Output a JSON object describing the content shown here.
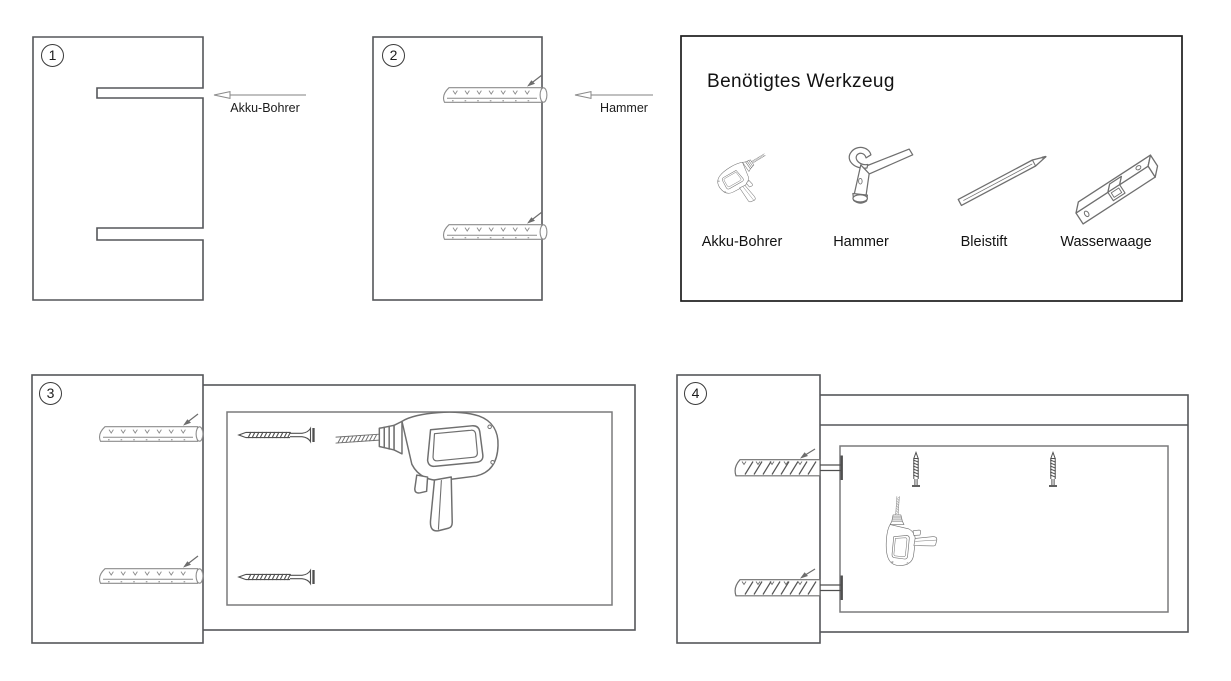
{
  "colors": {
    "background": "#ffffff",
    "panel_line": "#55565a",
    "detail_line": "#8c8c8c",
    "tools_border": "#1d1d1d",
    "text": "#121212"
  },
  "steps": [
    {
      "number": "1",
      "arrow_label": "Akku-Bohrer",
      "elements": [
        "wall-panel",
        "drilled-hole",
        "drilled-hole",
        "arrow-left-icon"
      ]
    },
    {
      "number": "2",
      "arrow_label": "Hammer",
      "elements": [
        "wall-panel",
        "wall-plug",
        "wall-plug",
        "arrow-left-icon"
      ]
    },
    {
      "number": "3",
      "elements": [
        "wall-panel",
        "wall-plug",
        "wall-plug",
        "mounting-board",
        "screw",
        "screw",
        "cordless-drill"
      ]
    },
    {
      "number": "4",
      "elements": [
        "wall-panel",
        "wall-plug-with-screw",
        "wall-plug-with-screw",
        "mounting-board",
        "screw",
        "screw",
        "cordless-drill"
      ]
    }
  ],
  "tools_panel": {
    "title": "Benötigtes Werkzeug",
    "tools": [
      {
        "label": "Akku-Bohrer",
        "icon": "cordless-drill-icon"
      },
      {
        "label": "Hammer",
        "icon": "hammer-icon"
      },
      {
        "label": "Bleistift",
        "icon": "pencil-icon"
      },
      {
        "label": "Wasserwaage",
        "icon": "spirit-level-icon"
      }
    ]
  }
}
